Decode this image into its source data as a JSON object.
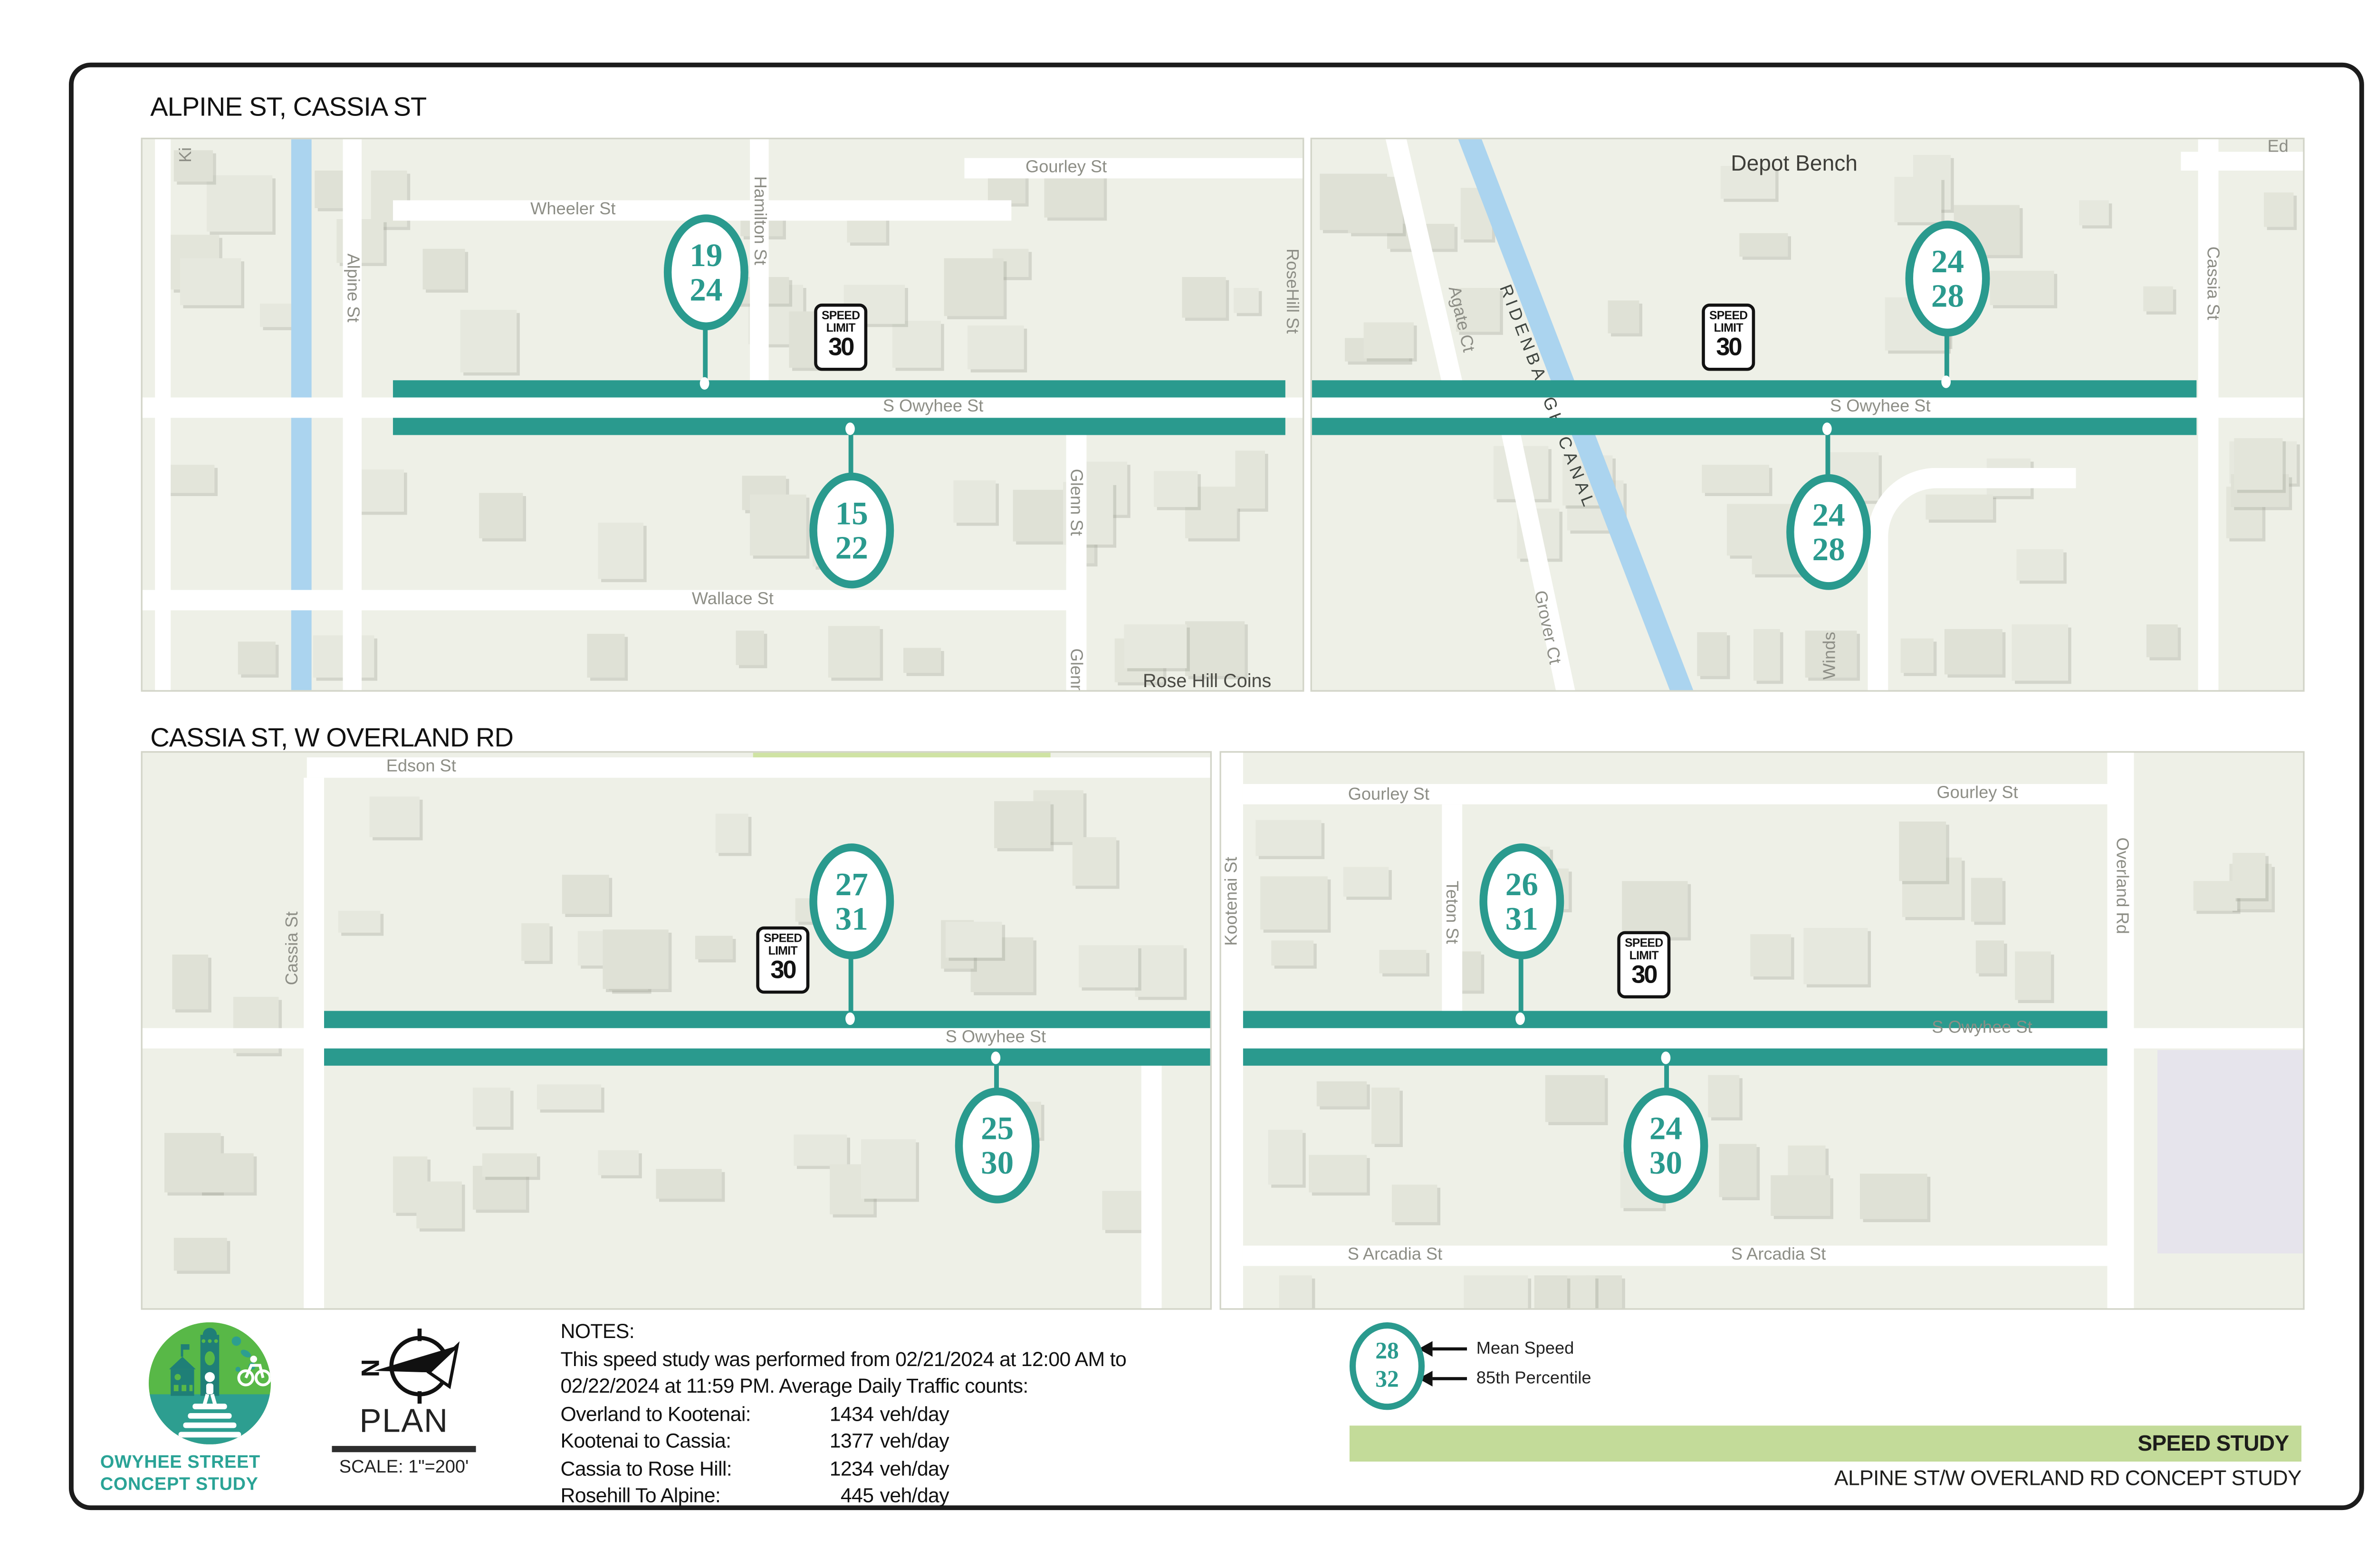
{
  "titles": {
    "panel1": "ALPINE ST, CASSIA ST",
    "panel2": "CASSIA ST, W OVERLAND RD"
  },
  "streets": {
    "s_owyhee": "S Owyhee St",
    "wheeler": "Wheeler St",
    "gourley": "Gourley St",
    "alpine": "Alpine St",
    "hamilton": "Hamilton St",
    "rosehill": "RoseHill St",
    "glenn_st": "Glenn St",
    "glenn": "Glenn",
    "wallace": "Wallace St",
    "rose_hill_coins": "Rose Hill Coins",
    "ki": "Ki",
    "ed": "Ed",
    "depot_bench": "Depot Bench",
    "ridenbaugh_canal": "RIDENBAUGH CANAL",
    "agate": "Agate Ct",
    "grover": "Grover Ct",
    "winds": "Winds",
    "cassia": "Cassia St",
    "edson": "Edson St",
    "kootenai": "Kootenai St",
    "teton": "Teton St",
    "overland": "Overland Rd",
    "s_arcadia": "S Arcadia St"
  },
  "speed_sign": {
    "line1": "SPEED",
    "line2": "LIMIT",
    "value": "30"
  },
  "speed_bubbles": {
    "alpine_segment_top": {
      "mean": "19",
      "p85": "24"
    },
    "alpine_segment_bottom": {
      "mean": "15",
      "p85": "22"
    },
    "cassia_segment_top": {
      "mean": "24",
      "p85": "28"
    },
    "cassia_segment_bottom": {
      "mean": "24",
      "p85": "28"
    },
    "west_segment_top": {
      "mean": "27",
      "p85": "31"
    },
    "west_segment_bottom": {
      "mean": "25",
      "p85": "30"
    },
    "east_segment_top": {
      "mean": "26",
      "p85": "31"
    },
    "east_segment_bottom": {
      "mean": "24",
      "p85": "30"
    }
  },
  "notes": {
    "heading": "NOTES:",
    "body_line1": "This speed study was performed from 02/21/2024 at 12:00 AM to",
    "body_line2": "02/22/2024 at 11:59 PM. Average Daily Traffic counts:",
    "counts": [
      {
        "label": "Overland to Kootenai:",
        "value": "1434",
        "unit": "veh/day"
      },
      {
        "label": "Kootenai to Cassia:",
        "value": "1377",
        "unit": "veh/day"
      },
      {
        "label": "Cassia to Rose Hill:",
        "value": "1234",
        "unit": "veh/day"
      },
      {
        "label": "Rosehill To Alpine:",
        "value": "445",
        "unit": "veh/day"
      }
    ]
  },
  "legend": {
    "mean_value": "28",
    "p85_value": "32",
    "mean_label": "Mean Speed",
    "p85_label": "85th Percentile"
  },
  "title_block": {
    "banner": "SPEED STUDY",
    "project": "ALPINE ST/W OVERLAND RD CONCEPT STUDY"
  },
  "logo": {
    "line1": "OWYHEE STREET",
    "line2": "CONCEPT STUDY"
  },
  "plan": {
    "label": "PLAN",
    "scale": "SCALE: 1\"=200'"
  },
  "colors": {
    "teal": "#2a9a8e",
    "banner_green": "#c3db99",
    "canal_blue": "#abd4ef",
    "logo_green": "#58b847",
    "logo_teal": "#2d9e90"
  }
}
